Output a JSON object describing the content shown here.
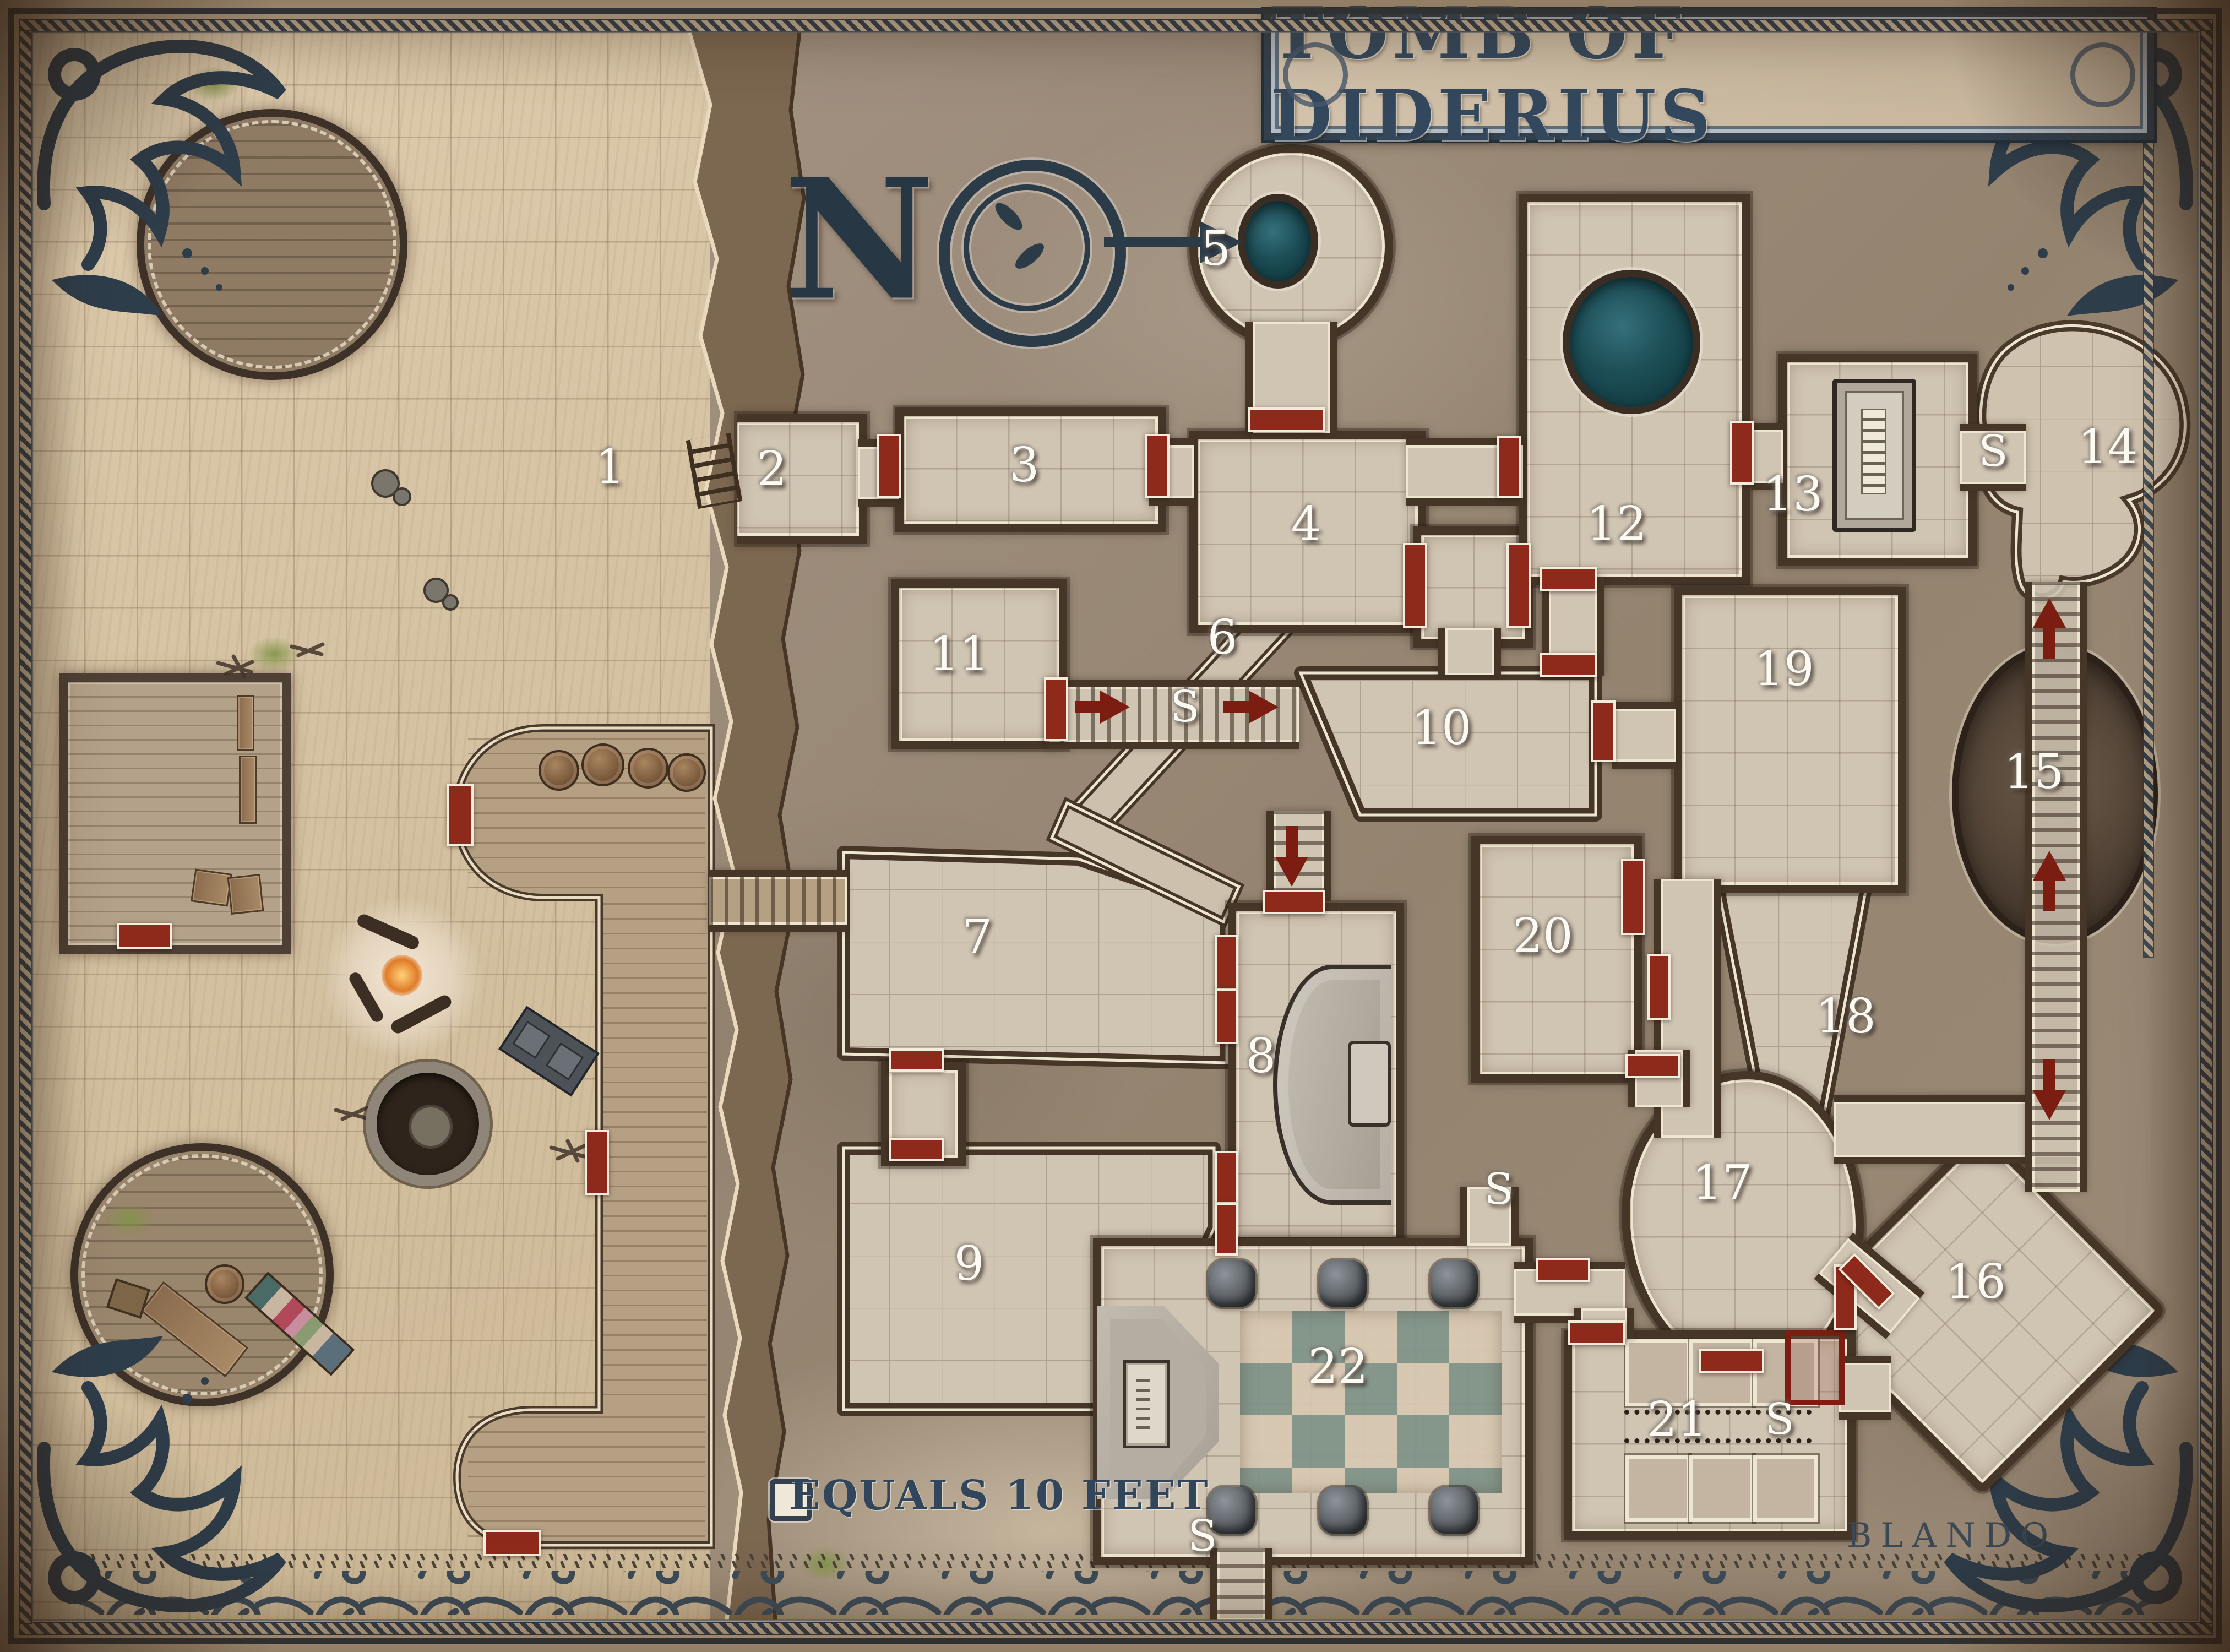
{
  "title": {
    "banner": "TOMB OF DIDERIUS"
  },
  "compass": {
    "letter": "N"
  },
  "scale_legend": {
    "text": "EQUALS 10 FEET"
  },
  "signature": {
    "artist": "BLANDO"
  },
  "rooms": [
    {
      "number": "1"
    },
    {
      "number": "2"
    },
    {
      "number": "3"
    },
    {
      "number": "4"
    },
    {
      "number": "5"
    },
    {
      "number": "6"
    },
    {
      "number": "7"
    },
    {
      "number": "8"
    },
    {
      "number": "9"
    },
    {
      "number": "10"
    },
    {
      "number": "11"
    },
    {
      "number": "12"
    },
    {
      "number": "13"
    },
    {
      "number": "14"
    },
    {
      "number": "15"
    },
    {
      "number": "16"
    },
    {
      "number": "17"
    },
    {
      "number": "18"
    },
    {
      "number": "19"
    },
    {
      "number": "20"
    },
    {
      "number": "21"
    },
    {
      "number": "22"
    }
  ],
  "secret_markers": [
    {
      "label": "S"
    },
    {
      "label": "S"
    },
    {
      "label": "S"
    },
    {
      "label": "S"
    },
    {
      "label": "S"
    }
  ],
  "colors": {
    "frame_slate": "#33404d",
    "parchment": "#d9c6a7",
    "dungeon_rock": "#9a8a7c",
    "room_floor": "#d0c4b2",
    "wall_dark": "#463627",
    "door_red": "#8e2a1c",
    "stair_arrow_red": "#7c1d12",
    "pool_teal": "#17464e",
    "checker_teal": "#8da095",
    "title_slate": "#33485c"
  }
}
